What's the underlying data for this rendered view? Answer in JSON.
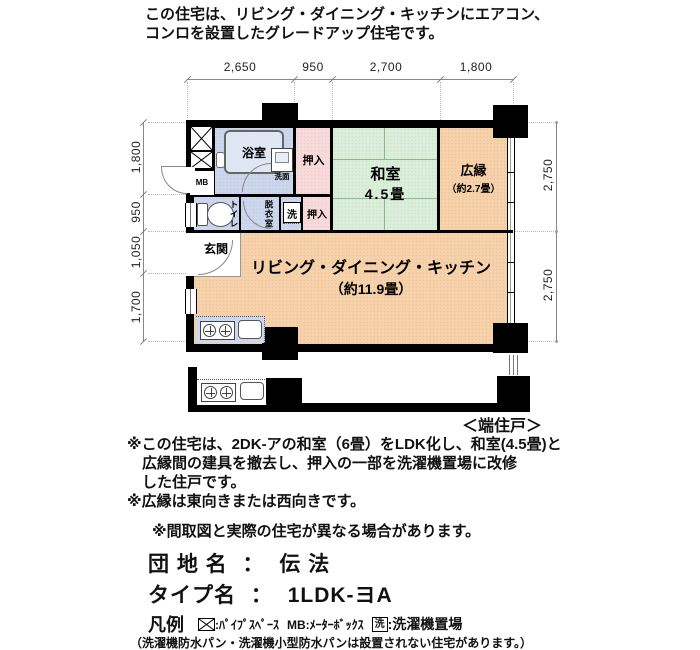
{
  "header": {
    "line1": "この住宅は、リビング・ダイニング・キッチンにエアコン、",
    "line2": "コンロを設置したグレードアップ住宅です。"
  },
  "dims": {
    "top": [
      "2,650",
      "950",
      "2,700",
      "1,800"
    ],
    "left": [
      "1,800",
      "950",
      "1,050",
      "1,700"
    ],
    "right": [
      "2,750",
      "2,750"
    ]
  },
  "rooms": {
    "bath": "浴室",
    "washbasin": "洗面",
    "mb": "MB",
    "oshiire_upper": "押入",
    "oshiire_lower": "押入",
    "washitsu_name": "和室",
    "washitsu_size": "4.5畳",
    "hiroen_name": "広縁",
    "hiroen_size": "（約2.7畳）",
    "toilet": "トイレ",
    "dressing": "脱衣室",
    "laundry": "洗",
    "genkan": "玄関",
    "ldk_name": "リビング・ダイニング・キッチン",
    "ldk_size": "（約11.9畳）"
  },
  "annotations": {
    "end_unit": "＜端住戸＞"
  },
  "notes": {
    "line1": "※この住宅は、2DK-アの和室（6畳）をLDK化し、和室(4.5畳)と",
    "line2": "広縁間の建具を撤去し、押入の一部を洗濯機置場に改修",
    "line3": "した住戸です。",
    "line4": "※広縁は東向きまたは西向きです。",
    "line5": "※間取図と実際の住宅が異なる場合があります。"
  },
  "estate": {
    "name_label": "団 地 名",
    "separator": "：",
    "name_value": "伝 法",
    "type_label": "タイプ名",
    "type_value": "1LDK-ヨA"
  },
  "legend": {
    "title": "凡例",
    "pipe_text": ":ﾊﾟｲﾌﾟｽﾍﾟｰｽ",
    "mb_text": "MB:ﾒｰﾀｰﾎﾞｯｸｽ",
    "laundry_symbol": "洗",
    "laundry_text": ":洗濯機置場",
    "disclaimer": "（洗濯機防水パン・洗濯機小型防水パンは設置されない住宅があります。）"
  },
  "colors": {
    "wet_area": "#ccd7ed",
    "closet": "#f8dada",
    "tatami": "#daeeda",
    "wood_floor": "#f6d1a9",
    "wall": "#000000"
  }
}
